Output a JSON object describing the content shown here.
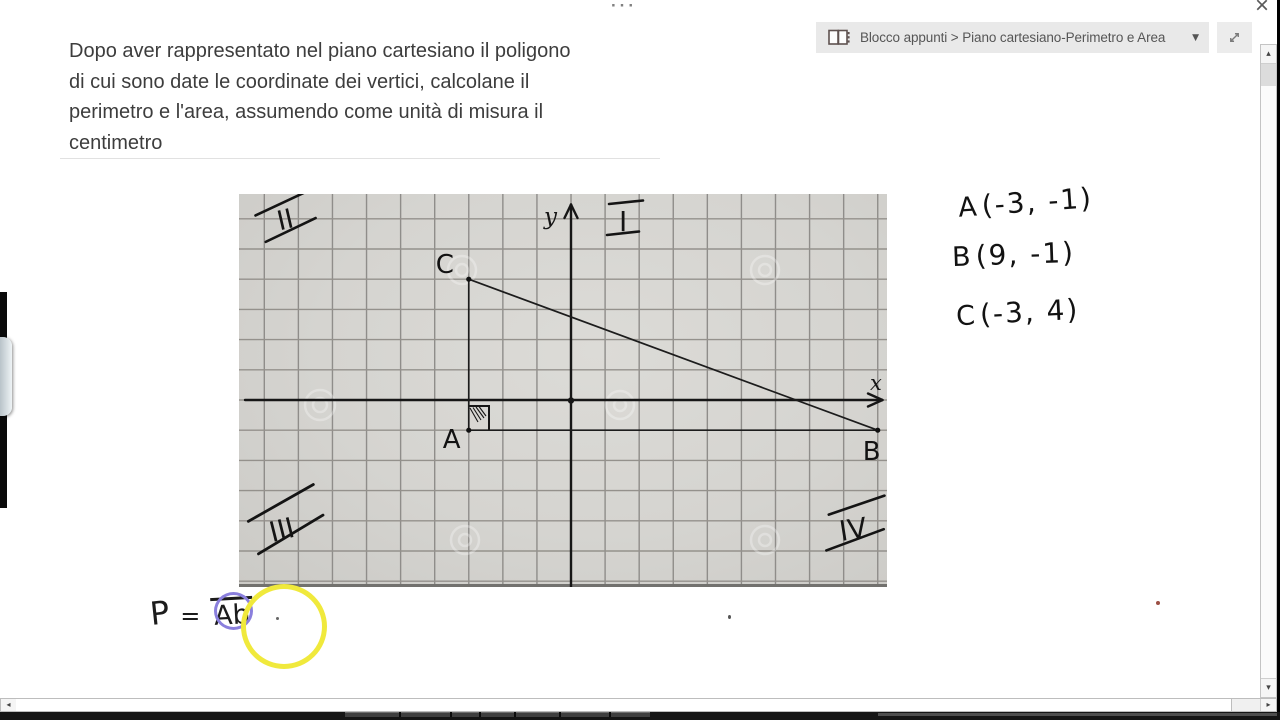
{
  "window": {
    "more_dots": "···",
    "close_glyph": "×"
  },
  "breadcrumb": {
    "path": "Blocco appunti > Piano cartesiano-Perimetro e Area",
    "dropdown_glyph": "▼"
  },
  "problem": {
    "text": "Dopo aver rappresentato nel piano cartesiano il poligono\ndi cui sono date le coordinate dei vertici, calcolane il\nperimetro e l'area, assumendo come unità di misura il\ncentimetro"
  },
  "graph": {
    "x_label": "x",
    "y_label": "y",
    "q1": "I",
    "q2": "II",
    "q3": "III",
    "q4": "IV"
  },
  "chart_data": {
    "type": "line",
    "title": "Poligono ABC sul piano cartesiano (carta quadrettata)",
    "points": [
      {
        "label": "A",
        "x": -3,
        "y": -1
      },
      {
        "label": "B",
        "x": 9,
        "y": -1
      },
      {
        "label": "C",
        "x": -3,
        "y": 4
      }
    ],
    "segments": [
      [
        "A",
        "B"
      ],
      [
        "A",
        "C"
      ],
      [
        "C",
        "B"
      ]
    ],
    "xlabel": "x",
    "ylabel": "y",
    "xlim": [
      -9.5,
      9.5
    ],
    "ylim": [
      -6,
      7
    ],
    "grid": true,
    "right_angle_at": "A",
    "quadrant_labels": [
      "I",
      "II",
      "III",
      "IV"
    ]
  },
  "coordinates": [
    {
      "label": "A",
      "value": "(-3, -1)"
    },
    {
      "label": "B",
      "value": "(9, -1)"
    },
    {
      "label": "C",
      "value": "(-3, 4)"
    }
  ],
  "formula": {
    "lhs": "P",
    "equals": "=",
    "rhs": "Ab"
  },
  "scrollbar": {
    "left_glyph": "◂",
    "right_glyph": "▸",
    "up_glyph": "▴",
    "down_glyph": "▾"
  },
  "colors": {
    "annotation_yellow": "#f0e93c",
    "annotation_purple": "#8a7fdd",
    "paper_grey": "#d6d5d1",
    "grid_line": "#8f8d8a",
    "ink": "#1c1c1c",
    "toolbar_bg": "#e9e9e9"
  }
}
